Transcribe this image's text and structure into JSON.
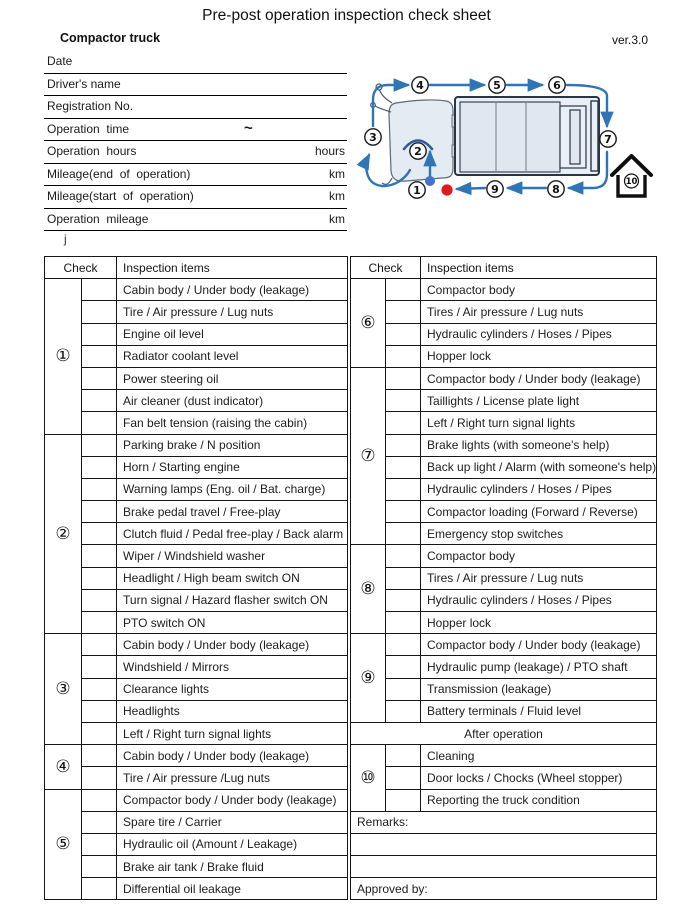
{
  "title": "Pre-post operation inspection check sheet",
  "version": "ver.3.0",
  "truck_type": "Compactor truck",
  "stray_char": "j",
  "form_fields": [
    {
      "label": "Date",
      "mid": "",
      "unit": ""
    },
    {
      "label": "Driver's name",
      "mid": "",
      "unit": ""
    },
    {
      "label": "Registration No.",
      "mid": "",
      "unit": ""
    },
    {
      "label": "Operation  time",
      "mid": "~",
      "unit": ""
    },
    {
      "label": "Operation  hours",
      "mid": "",
      "unit": "hours"
    },
    {
      "label": "Mileage(end  of  operation)",
      "mid": "",
      "unit": "km"
    },
    {
      "label": "Mileage(start  of  operation)",
      "mid": "",
      "unit": "km"
    },
    {
      "label": "Operation  mileage",
      "mid": "",
      "unit": "km"
    }
  ],
  "tables": {
    "header_check": "Check",
    "header_items": "Inspection items",
    "left_groups": [
      {
        "num": "①",
        "items": [
          "Cabin body / Under body (leakage)",
          "Tire / Air pressure / Lug nuts",
          "Engine oil level",
          "Radiator coolant level",
          "Power steering oil",
          "Air cleaner (dust indicator)",
          "Fan belt tension (raising the cabin)"
        ]
      },
      {
        "num": "②",
        "items": [
          "Parking brake / N position",
          "Horn / Starting engine",
          "Warning lamps (Eng. oil / Bat. charge)",
          "Brake pedal travel / Free-play",
          "Clutch fluid / Pedal free-play / Back alarm",
          "Wiper / Windshield washer",
          "Headlight / High beam switch ON",
          "Turn signal / Hazard flasher switch ON",
          "PTO switch ON"
        ]
      },
      {
        "num": "③",
        "items": [
          "Cabin body / Under body (leakage)",
          "Windshield / Mirrors",
          "Clearance lights",
          "Headlights",
          "Left / Right turn signal lights"
        ]
      },
      {
        "num": "④",
        "items": [
          "Cabin body / Under body (leakage)",
          "Tire / Air pressure /Lug nuts"
        ]
      },
      {
        "num": "⑤",
        "items": [
          "Compactor body / Under body (leakage)",
          "Spare tire / Carrier",
          "Hydraulic oil (Amount / Leakage)",
          "Brake air tank / Brake fluid",
          "Differential oil leakage"
        ]
      }
    ],
    "right_groups": [
      {
        "num": "⑥",
        "items": [
          "Compactor body",
          "Tires / Air pressure / Lug nuts",
          "Hydraulic cylinders / Hoses / Pipes",
          "Hopper lock"
        ]
      },
      {
        "num": "⑦",
        "items": [
          "Compactor body / Under body (leakage)",
          "Taillights / License plate light",
          "Left / Right turn signal lights",
          "Brake lights (with someone's help)",
          "Back up light / Alarm (with someone's help)",
          "Hydraulic cylinders / Hoses / Pipes",
          "Compactor loading (Forward / Reverse)",
          "Emergency stop switches"
        ]
      },
      {
        "num": "⑧",
        "items": [
          "Compactor body",
          "Tires / Air pressure / Lug nuts",
          "Hydraulic cylinders / Hoses / Pipes",
          "Hopper lock"
        ]
      },
      {
        "num": "⑨",
        "items": [
          "Compactor body / Under body (leakage)",
          "Hydraulic pump (leakage) / PTO shaft",
          "Transmission (leakage)",
          "Battery terminals / Fluid level"
        ]
      }
    ],
    "after_operation_label": "After operation",
    "right_groups_after": [
      {
        "num": "⑩",
        "items": [
          "Cleaning",
          "Door locks / Chocks (Wheel stopper)",
          "Reporting the truck condition"
        ]
      }
    ],
    "remarks_label": "Remarks:",
    "approved_label": "Approved by:"
  },
  "diagram": {
    "stop_labels": [
      "1",
      "2",
      "3",
      "4",
      "5",
      "6",
      "7",
      "8",
      "9"
    ],
    "house_label": "10",
    "colors": {
      "arrow": "#2e75b6",
      "steer": "#2f5ba0",
      "start_dot": "#e01b1b",
      "inside_dot": "#4472c4"
    }
  }
}
